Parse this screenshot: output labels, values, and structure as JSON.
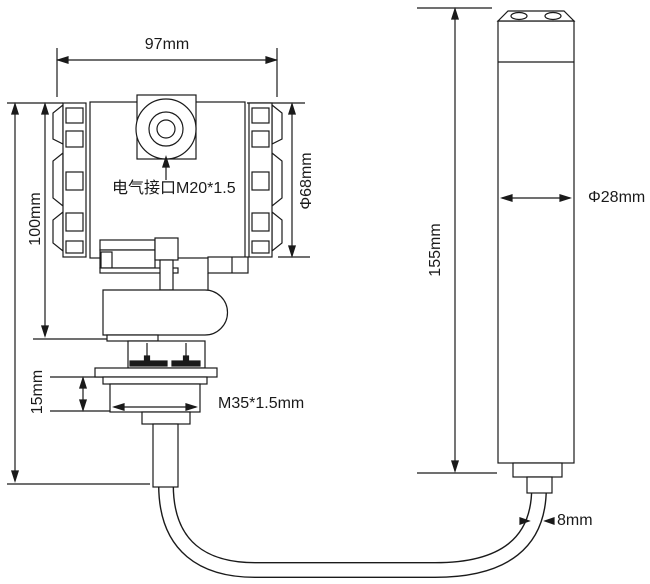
{
  "labels": {
    "head_width": "97mm",
    "electrical_port": "电气接口M20*1.5",
    "head_diameter": "Φ68mm",
    "head_height": "100mm",
    "thread_height": "15mm",
    "thread_spec": "M35*1.5mm",
    "probe_length": "155mm",
    "probe_diameter": "Φ28mm",
    "cable_diameter": "8mm"
  },
  "colors": {
    "line": "#1a1a1a",
    "background": "#ffffff"
  }
}
